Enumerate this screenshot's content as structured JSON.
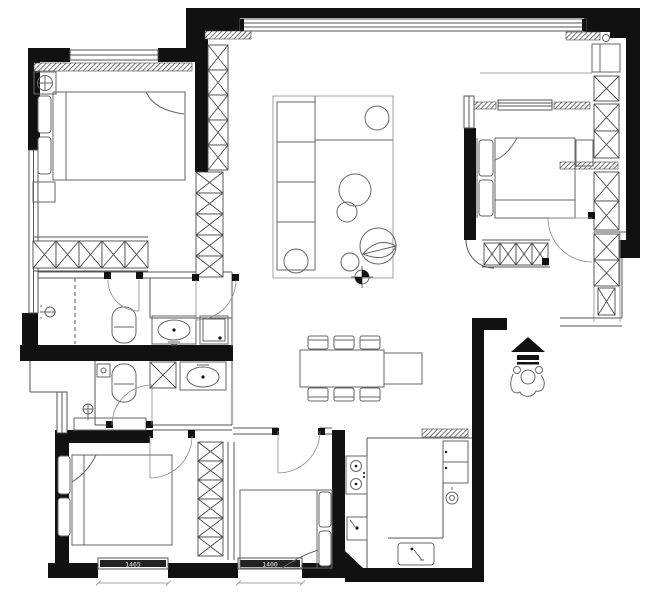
{
  "meta": {
    "title": "apartment-floor-plan",
    "canvas": {
      "width": 650,
      "height": 596
    }
  },
  "palette": {
    "background": "#ffffff",
    "wall": "#111111",
    "line": "#555555",
    "furniture": "#666666",
    "light_line": "#8a8a8a",
    "dimension_band": "#222222",
    "dimension_text": "#eeeeee"
  },
  "dimensions": {
    "left_window_label": "1465",
    "middle_window_label": "1400"
  },
  "legend": {
    "symbols": [
      "bed",
      "pillow",
      "wardrobe-x-cabinet",
      "closet",
      "sofa",
      "rug",
      "side-table",
      "coffee-table",
      "plant",
      "pouf",
      "surveyor-target",
      "dining-table",
      "dining-chair",
      "toilet",
      "wash-basin",
      "vanity",
      "washer",
      "shower-head",
      "floor-drain",
      "cooktop",
      "kitchen-sink",
      "fridge",
      "gas-meter",
      "table-lamp",
      "ceiling-light",
      "door-swing",
      "window",
      "insulation-hatch",
      "entry-figure",
      "entry-arrow",
      "threshold",
      "dimension-line"
    ]
  }
}
